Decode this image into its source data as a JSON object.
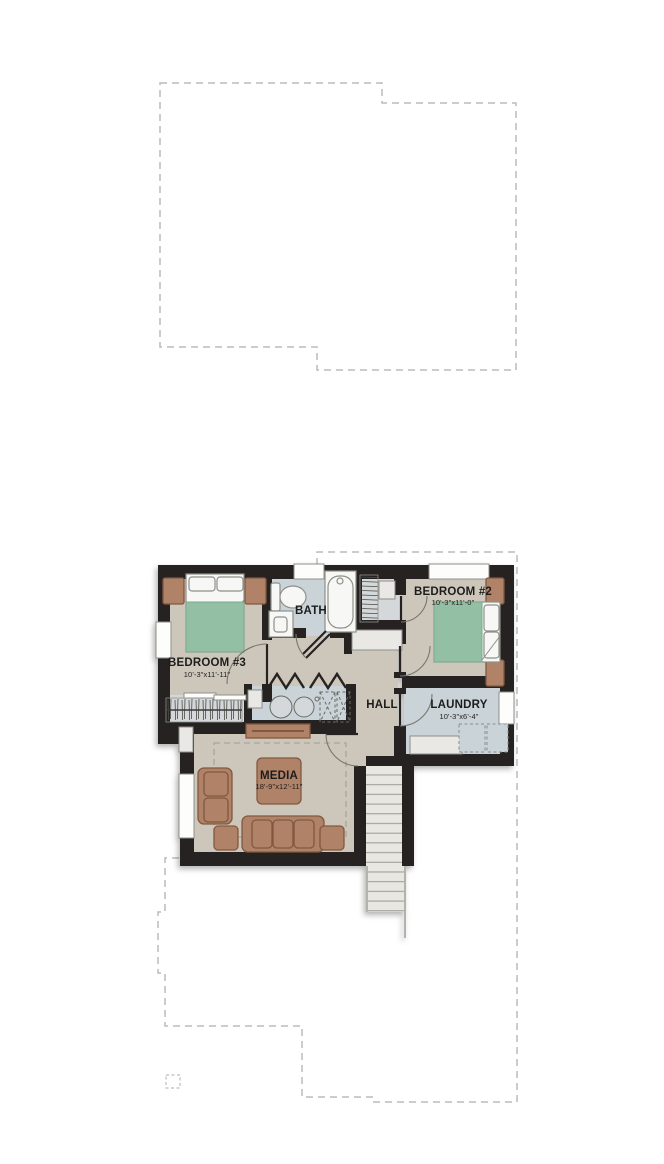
{
  "plan_title": "Second floor plan",
  "rooms": {
    "bedroom2": {
      "name": "BEDROOM #2",
      "dims": "10'-3\"x11'-0\""
    },
    "bedroom3": {
      "name": "BEDROOM #3",
      "dims": "10'-3\"x11'-11\""
    },
    "bath": {
      "name": "BATH"
    },
    "hall": {
      "name": "HALL"
    },
    "laundry": {
      "name": "LAUNDRY",
      "dims": "10'-3\"x6'-4\""
    },
    "media": {
      "name": "MEDIA",
      "dims": "18'-9\"x12'-11\""
    }
  },
  "colors": {
    "wall": "#272320",
    "floor_warm": "#cdc7bb",
    "floor_cool": "#c9d3d8",
    "floor_closet": "#d4d8da",
    "bed_green": "#93bfa4",
    "furniture": "#b08267",
    "furniture_dark": "#81583f",
    "fixture": "#f7f7f5",
    "fixture_line": "#8f8f89",
    "stair": "#e8e7e2",
    "stair_line": "#98978f",
    "dash": "#bcbcbc",
    "rug_dash": "#a5a59e",
    "window": "#fdfdfc",
    "shelf": "#e9e8e4",
    "text": "#1f1f1d"
  }
}
